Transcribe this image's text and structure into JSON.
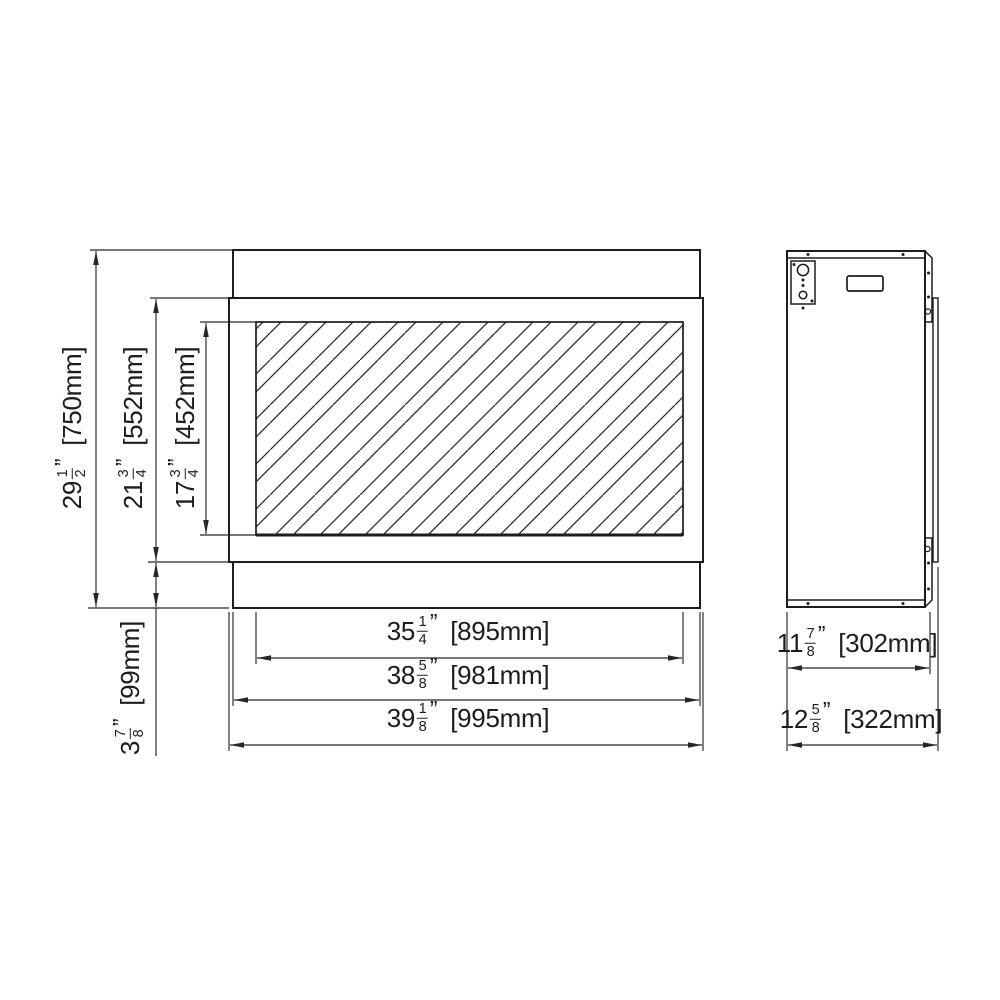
{
  "colors": {
    "line": "#1d1d1d",
    "dimension_line": "#262626",
    "background": "#ffffff"
  },
  "labels": {
    "overall_height": {
      "whole": "29",
      "num": "1",
      "den": "2",
      "unit": "”",
      "metric": "[750mm]"
    },
    "opening_height": {
      "whole": "21",
      "num": "3",
      "den": "4",
      "unit": "”",
      "metric": "[552mm]"
    },
    "glass_height": {
      "whole": "17",
      "num": "3",
      "den": "4",
      "unit": "”",
      "metric": "[452mm]"
    },
    "base_height": {
      "whole": "3",
      "num": "7",
      "den": "8",
      "unit": "”",
      "metric": "[99mm]"
    },
    "glass_width": {
      "whole": "35",
      "num": "1",
      "den": "4",
      "unit": "”",
      "metric": "[895mm]"
    },
    "firebox_width": {
      "whole": "38",
      "num": "5",
      "den": "8",
      "unit": "”",
      "metric": "[981mm]"
    },
    "overall_width": {
      "whole": "39",
      "num": "1",
      "den": "8",
      "unit": "”",
      "metric": "[995mm]"
    },
    "depth_body": {
      "whole": "11",
      "num": "7",
      "den": "8",
      "unit": "”",
      "metric": "[302mm]"
    },
    "depth_overall": {
      "whole": "12",
      "num": "5",
      "den": "8",
      "unit": "”",
      "metric": "[322mm]"
    }
  }
}
